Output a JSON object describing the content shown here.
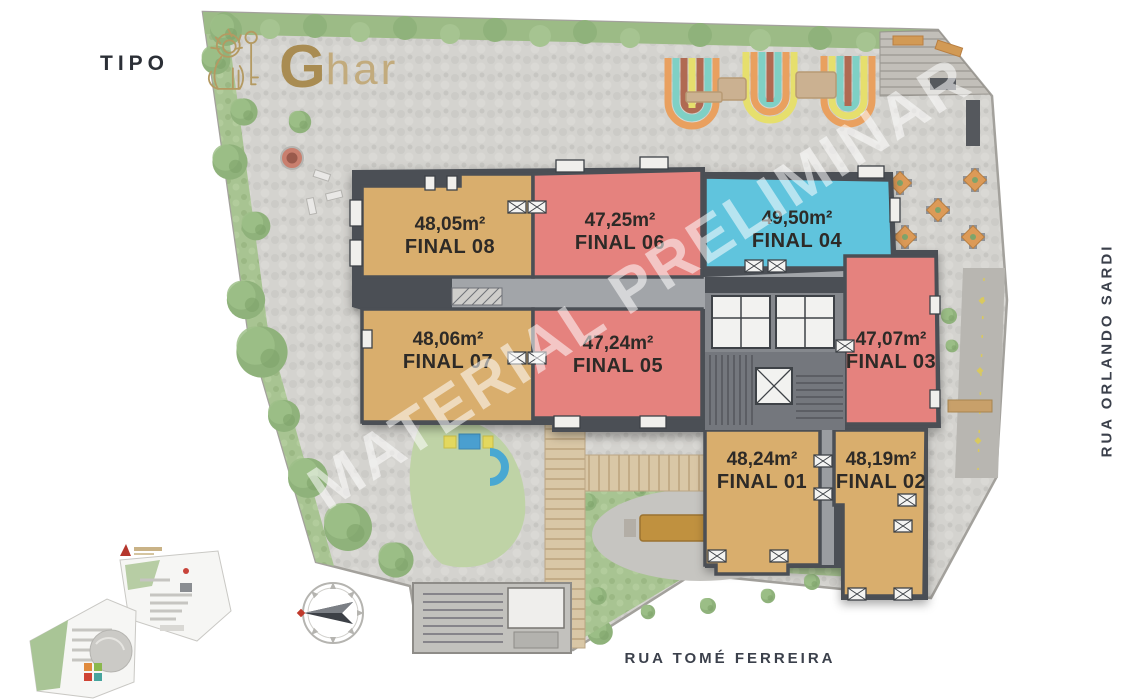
{
  "header": {
    "tipo": "TIPO",
    "brand_initial": "G",
    "brand_rest": "har"
  },
  "watermark": {
    "text": "MATERIAL PRELIMINAR"
  },
  "streets": {
    "right": "RUA ORLANDO SARDI",
    "bottom": "RUA TOMÉ FERREIRA"
  },
  "plan": {
    "units": [
      {
        "id": "final-08",
        "area": "48,05m²",
        "name": "FINAL 08",
        "color": "#d9ae6d"
      },
      {
        "id": "final-06",
        "area": "47,25m²",
        "name": "FINAL 06",
        "color": "#e5827e"
      },
      {
        "id": "final-04",
        "area": "49,50m²",
        "name": "FINAL 04",
        "color": "#60c4dd"
      },
      {
        "id": "final-07",
        "area": "48,06m²",
        "name": "FINAL 07",
        "color": "#d9ae6d"
      },
      {
        "id": "final-05",
        "area": "47,24m²",
        "name": "FINAL 05",
        "color": "#e5827e"
      },
      {
        "id": "final-03",
        "area": "47,07m²",
        "name": "FINAL 03",
        "color": "#e5827e"
      },
      {
        "id": "final-01",
        "area": "48,24m²",
        "name": "FINAL 01",
        "color": "#d9ae6d"
      },
      {
        "id": "final-02",
        "area": "48,19m²",
        "name": "FINAL 02",
        "color": "#d9ae6d"
      }
    ],
    "colors": {
      "unit_gold": "#d9ae6d",
      "unit_red": "#e5827e",
      "unit_blue": "#60c4dd",
      "walls": "#4b4f55",
      "ground": "#d4d3cf",
      "green": "#a4c18e",
      "brand_gold": "#b49a62"
    }
  }
}
